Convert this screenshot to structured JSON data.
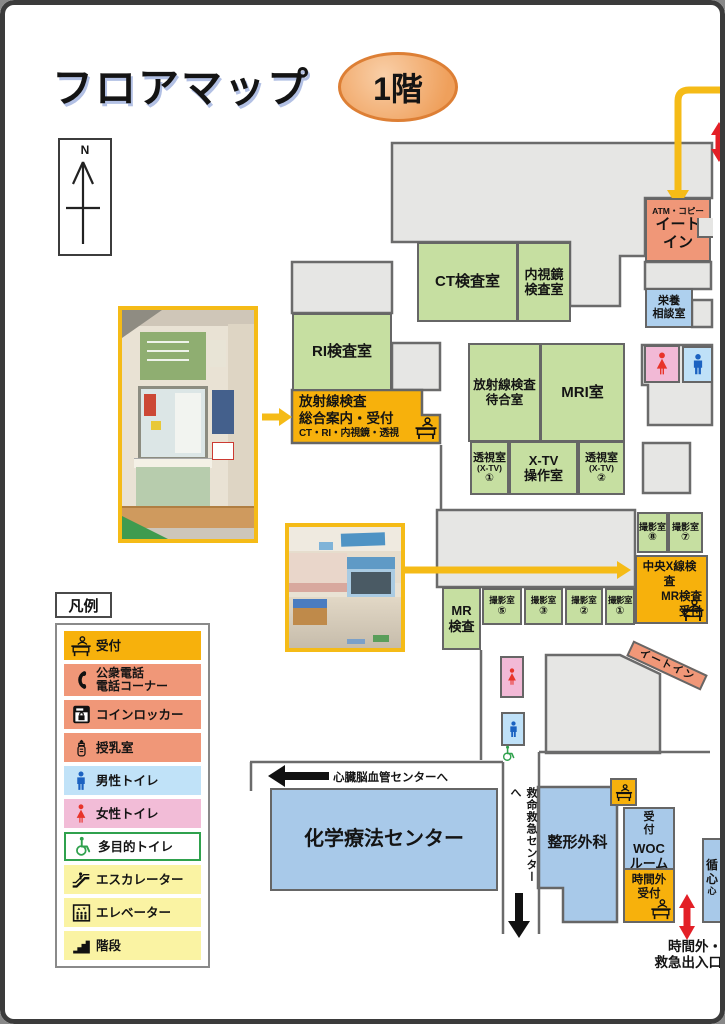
{
  "header": {
    "title": "フロアマップ",
    "floor_badge": "1階"
  },
  "compass": {
    "north_label": "N"
  },
  "colors": {
    "accent_yellow": "#f5bb17",
    "reception_yellow": "#f7b10c",
    "room_green": "#c6dfa1",
    "room_salmon": "#f09778",
    "room_blue": "#a8c9e9",
    "toilet_pink": "#f2b9d6",
    "toilet_blue": "#bfe1f8",
    "legend_pale_yellow": "#faf3a3",
    "multipurpose_green": "#2fa14d",
    "arrow_red": "#e31f26",
    "building_gray": "#e6e6e4"
  },
  "rooms": {
    "atm_copy": {
      "label": "ATM・コピー"
    },
    "eat_in": {
      "lines": [
        "イート",
        "イン"
      ]
    },
    "nutrition": {
      "lines": [
        "栄養",
        "相談室"
      ]
    },
    "ct": {
      "label": "CT検査室"
    },
    "endoscopy": {
      "lines": [
        "内視鏡",
        "検査室"
      ]
    },
    "ri": {
      "label": "RI検査室"
    },
    "radiology_reception": {
      "lines": [
        "放射線検査",
        "総合案内・受付",
        "CT・RI・内視鏡・透視"
      ]
    },
    "radiology_waiting": {
      "lines": [
        "放射線検査",
        "待合室"
      ]
    },
    "mri": {
      "label": "MRI室"
    },
    "fluoroscopy_1": {
      "lines": [
        "透視室",
        "(X-TV)",
        "①"
      ]
    },
    "xtv_control": {
      "lines": [
        "X-TV",
        "操作室"
      ]
    },
    "fluoroscopy_2": {
      "lines": [
        "透視室",
        "(X-TV)",
        "②"
      ]
    },
    "xray_8": {
      "lines": [
        "撮影室",
        "⑧"
      ]
    },
    "xray_7": {
      "lines": [
        "撮影室",
        "⑦"
      ]
    },
    "central_xray_reception": {
      "lines": [
        "中央X線検査",
        "MR検査",
        "受付"
      ]
    },
    "mr_exam": {
      "lines": [
        "MR",
        "検査"
      ]
    },
    "xray_5": {
      "lines": [
        "撮影室",
        "⑤"
      ]
    },
    "xray_3": {
      "lines": [
        "撮影室",
        "③"
      ]
    },
    "xray_2": {
      "lines": [
        "撮影室",
        "②"
      ]
    },
    "xray_1": {
      "lines": [
        "撮影室",
        "①"
      ]
    },
    "eat_in_corner": {
      "label": "イートイン"
    },
    "chemotherapy": {
      "label": "化学療法センター"
    },
    "orthopedics": {
      "label": "整形外科"
    },
    "reception_mini": {
      "label": "受付"
    },
    "woc": {
      "lines": [
        "WOC",
        "ルーム"
      ]
    },
    "after_hours_reception": {
      "lines": [
        "時間外",
        "受付"
      ]
    },
    "cardiology_clipped": {
      "lines": [
        "循",
        "心",
        "心"
      ]
    }
  },
  "wayfinding": {
    "to_heart_brain_center": "心臓脳血管センターへ",
    "to_emergency_center": "救命救急センターへ",
    "after_hours_entrance": {
      "lines": [
        "時間外・",
        "救急出入口"
      ]
    }
  },
  "legend": {
    "title": "凡例",
    "items": [
      {
        "label": "受付",
        "icon": "reception-icon",
        "color": "#f7b10c"
      },
      {
        "lines": [
          "公衆電話",
          "電話コーナー"
        ],
        "icon": "public-phone-icon",
        "color": "#f09778"
      },
      {
        "label": "コインロッカー",
        "icon": "coin-locker-icon",
        "color": "#f09778"
      },
      {
        "label": "授乳室",
        "icon": "nursing-room-icon",
        "color": "#f09778"
      },
      {
        "label": "男性トイレ",
        "icon": "male-toilet-icon",
        "color": "#c0e2f8"
      },
      {
        "label": "女性トイレ",
        "icon": "female-toilet-icon",
        "color": "#f2bcd7"
      },
      {
        "label": "多目的トイレ",
        "icon": "accessible-toilet-icon",
        "color": "#ffffff"
      },
      {
        "label": "エスカレーター",
        "icon": "escalator-icon",
        "color": "#faf3a3"
      },
      {
        "label": "エレベーター",
        "icon": "elevator-icon",
        "color": "#faf3a3"
      },
      {
        "label": "階段",
        "icon": "stairs-icon",
        "color": "#faf3a3"
      }
    ]
  }
}
